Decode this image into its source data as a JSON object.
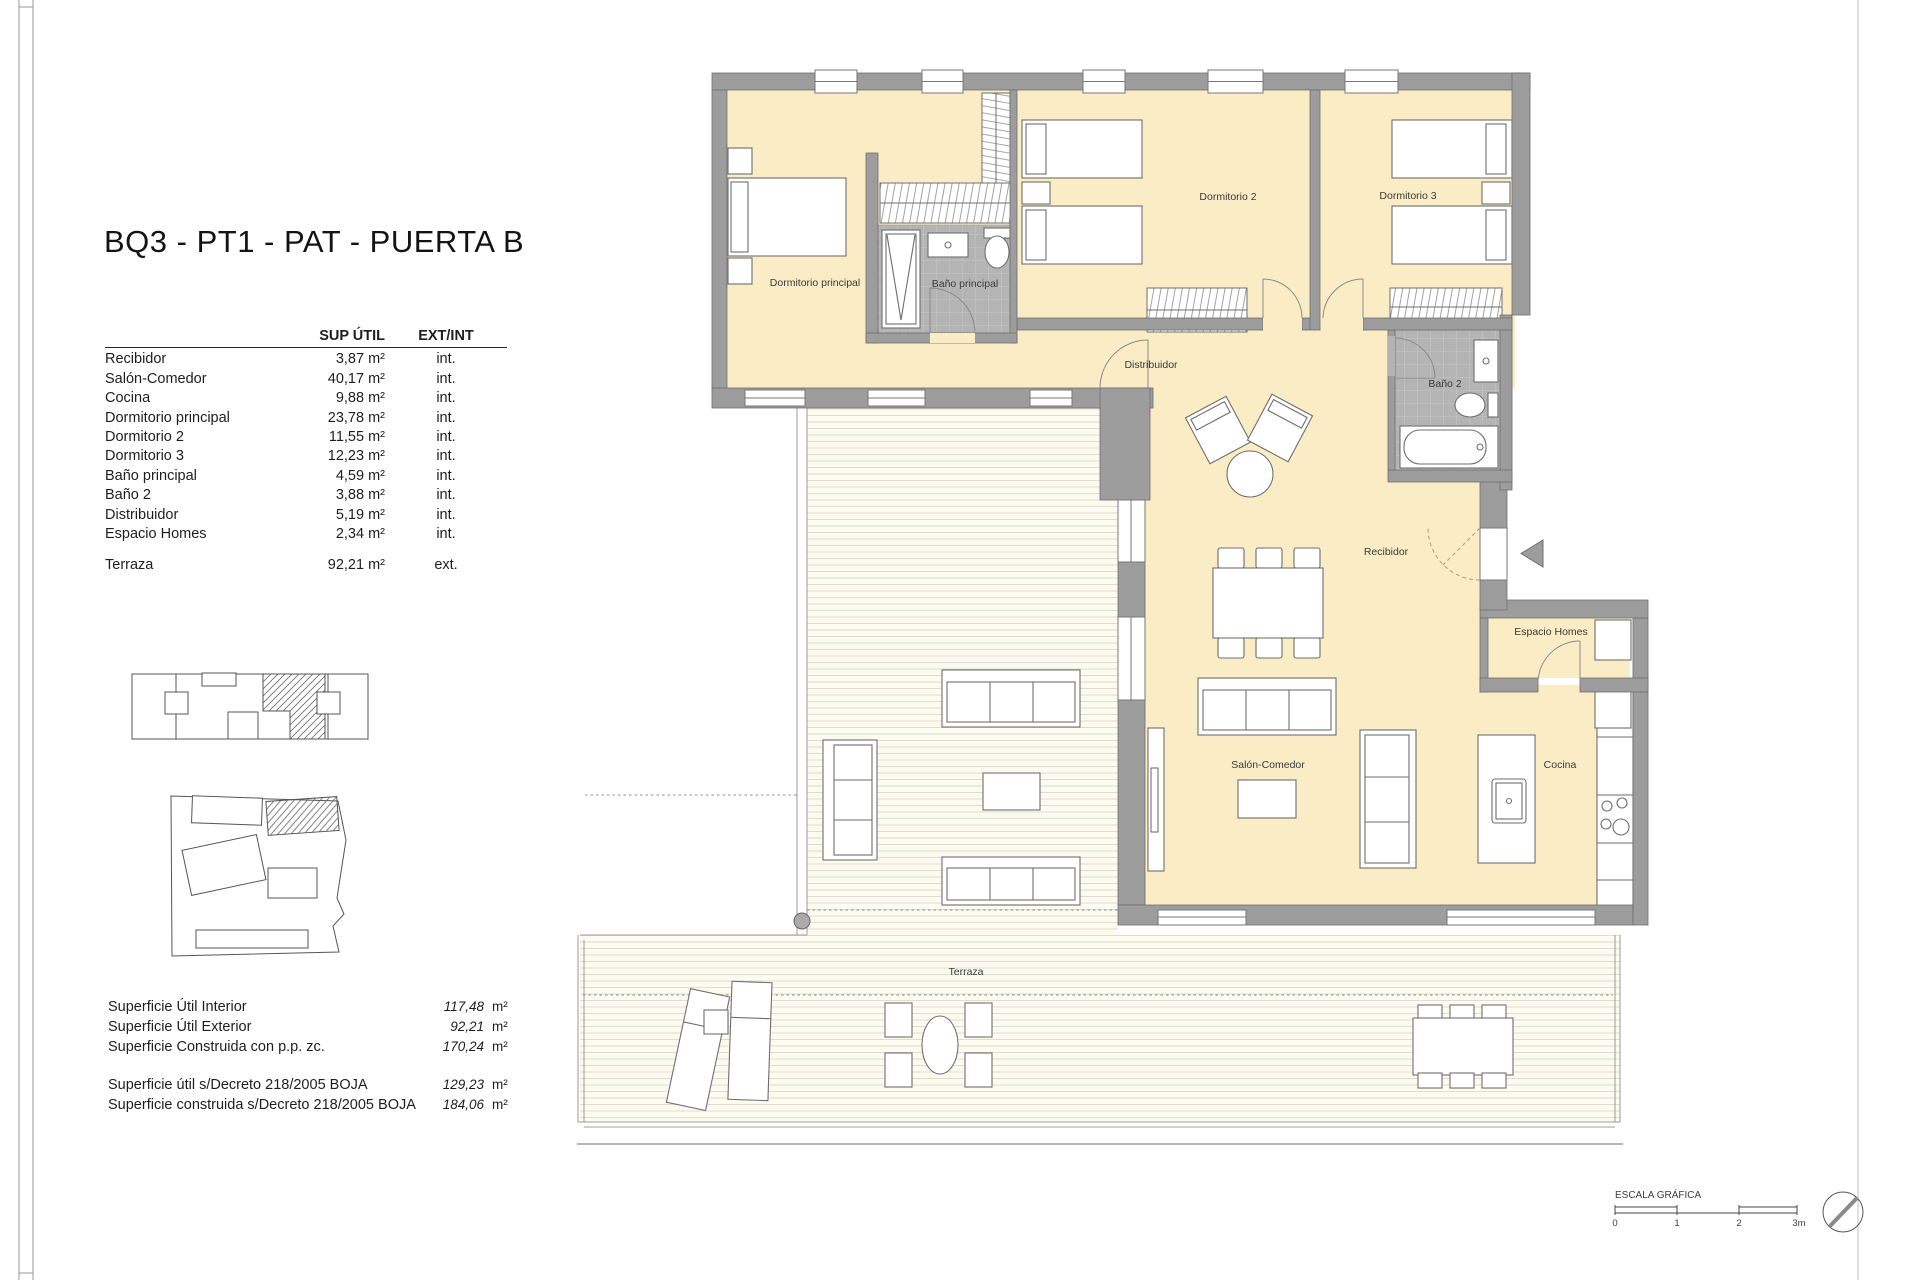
{
  "title": "BQ3 - PT1 - PAT - PUERTA B",
  "table": {
    "header": {
      "area": "SUP ÚTIL",
      "ext_int": "EXT/INT"
    },
    "rows": [
      {
        "name": "Recibidor",
        "area": "3,87 m²",
        "type": "int."
      },
      {
        "name": "Salón-Comedor",
        "area": "40,17 m²",
        "type": "int."
      },
      {
        "name": "Cocina",
        "area": "9,88 m²",
        "type": "int."
      },
      {
        "name": "Dormitorio principal",
        "area": "23,78 m²",
        "type": "int."
      },
      {
        "name": "Dormitorio 2",
        "area": "11,55 m²",
        "type": "int."
      },
      {
        "name": "Dormitorio 3",
        "area": "12,23 m²",
        "type": "int."
      },
      {
        "name": "Baño principal",
        "area": "4,59 m²",
        "type": "int."
      },
      {
        "name": "Baño 2",
        "area": "3,88 m²",
        "type": "int."
      },
      {
        "name": "Distribuidor",
        "area": "5,19 m²",
        "type": "int."
      },
      {
        "name": "Espacio Homes",
        "area": "2,34 m²",
        "type": "int."
      },
      {
        "name": "Terraza",
        "area": "92,21 m²",
        "type": "ext."
      }
    ]
  },
  "summary": {
    "rows1": [
      {
        "label": "Superficie Útil Interior",
        "value": "117,48",
        "unit": "m²"
      },
      {
        "label": "Superficie Útil Exterior",
        "value": "92,21",
        "unit": "m²"
      },
      {
        "label": "Superficie Construida con p.p. zc.",
        "value": "170,24",
        "unit": "m²"
      }
    ],
    "rows2": [
      {
        "label": "Superficie útil s/Decreto 218/2005 BOJA",
        "value": "129,23",
        "unit": "m²"
      },
      {
        "label": "Superficie construida s/Decreto 218/2005 BOJA",
        "value": "184,06",
        "unit": "m²"
      }
    ]
  },
  "plan": {
    "labels": {
      "dormitorio_principal": "Dormitorio principal",
      "bano_principal": "Baño principal",
      "dormitorio_2": "Dormitorio 2",
      "dormitorio_3": "Dormitorio 3",
      "bano_2": "Baño 2",
      "distribuidor": "Distribuidor",
      "recibidor": "Recibidor",
      "espacio_homes": "Espacio Homes",
      "salon_comedor": "Salón-Comedor",
      "cocina": "Cocina",
      "terraza": "Terraza"
    }
  },
  "scale_bar": {
    "title": "ESCALA GRÁFICA",
    "ticks": [
      "0",
      "1",
      "2",
      "3m"
    ]
  },
  "colors": {
    "room_fill": "#FAEDC5",
    "wall": "#9D9D9D",
    "bath_tile": "#B4B4B4",
    "terrace_stripe": "#E0DDC8"
  }
}
